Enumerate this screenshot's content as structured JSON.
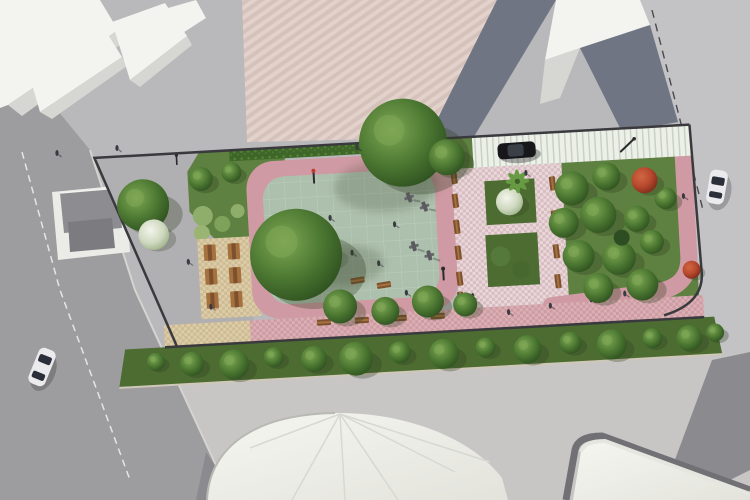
{
  "scene": {
    "title": "Aerial 3D architectural render of a rectangular pocket park",
    "view": "top-down bird's-eye, slight tilt",
    "setting": "urban block bounded by gray streets and white flat-roof buildings",
    "park_features": [
      "entry plaza with gray-roof kiosk",
      "lawn with round shrubs and clipped hedge",
      "tan checker picnic terrace with six wooden tables",
      "sage-green playground safety surface with tile grid",
      "wooden play structure with yellow and green slides",
      "outdoor fitness equipment cluster",
      "pink mosaic promenade with bench rows",
      "two square planter beds, one with palm and white-flowering shrub",
      "tree grove with two red-leaf trees and curving pink path",
      "striped parallel-parking strip with black parked car",
      "south promenade with benches and tree-lined green buffer",
      "street lamps and scattered pedestrians"
    ],
    "vehicles": [
      "black car in park parking strip",
      "white car on right street",
      "white car on bottom-left street"
    ],
    "surroundings": [
      "white slab-roof buildings top-left",
      "pink striped forecourt top-center",
      "dark blue-gray roof wedges top-center",
      "white building top-right",
      "white dome-roof hall bottom-center",
      "white curved-roof building bottom-right"
    ]
  },
  "palette": {
    "pavement": "#b9b8ba",
    "sidewalk": "#c8c6c4",
    "road_left": "#9d9c9e",
    "road_right": "#c3c2c4",
    "road_dark": "#8b8a8e",
    "bldg_white": "#f3f3ef",
    "bldg_side": "#d6d6d2",
    "roof_dark": "#6f7582",
    "plaza_pink": "#d5c2bb",
    "plaza_pink2": "#e2d2cb",
    "park_plaza": "#b0afb1",
    "curb": "#3a3a3e",
    "grass": "#5e8040",
    "grass_dark": "#4c6c31",
    "hedge": "#3e6629",
    "hedge2": "#578336",
    "sage": "#adc0ad",
    "sage_grid": "#c9d6c9",
    "path_pink": "#cf9aa3",
    "mosaic1": "#e8d8da",
    "mosaic2": "#d9bcc1",
    "walk1": "#d9b0b5",
    "walk2": "#cf9ba2",
    "tan1": "#dccca9",
    "tan2": "#cdbb92",
    "parking1": "#edf0e9",
    "parking2": "#c6d2c2",
    "wood": "#7d512e",
    "wood2": "#a5713f",
    "tree_hi": "#7fa855",
    "tree_mid": "#4e7a33",
    "tree_dark": "#2f5220",
    "red_hi": "#d06742",
    "red_mid": "#b8492e",
    "red_dark": "#7e2c1a",
    "bush_hi": "#f2f5ec",
    "bush_mid": "#cfd9c0",
    "bush_dark": "#9fb28a",
    "car_black": "#17171b",
    "car_white": "#ebebed",
    "car_window": "#2a2f3a",
    "metal": "#5b5b5f",
    "kiosk_roof": "#8d8d91",
    "kiosk_roof2": "#7c7c80",
    "kiosk_pad": "#ebebe7",
    "lamp": "#2b2b2e",
    "person": "#3a3a40",
    "shadow": "#2e3a22",
    "play_deck": "#b3702f",
    "play_roof": "#57a03c",
    "play_yellow": "#e3b62e",
    "play_green": "#4e9a3c",
    "dome_hi": "#f6f6f1",
    "dome_lo": "#e3e3dc",
    "seam": "#d8d8d3"
  }
}
